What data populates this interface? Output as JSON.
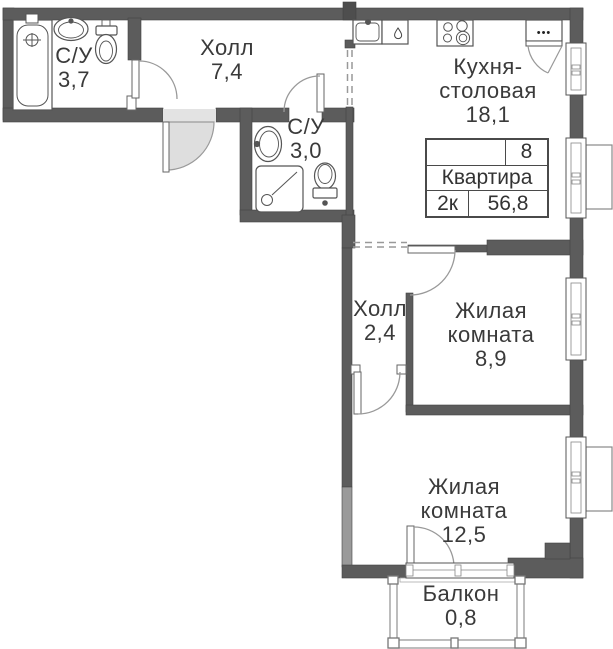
{
  "apartment_card": {
    "number": "8",
    "title": "Квартира",
    "rooms_count": "2к",
    "total_area": "56,8"
  },
  "rooms": {
    "bathroom_top": {
      "name": "С/У",
      "area": "3,7"
    },
    "hall_top": {
      "name": "Холл",
      "area": "7,4"
    },
    "kitchen": {
      "line1": "Кухня-",
      "line2": "столовая",
      "area": "18,1"
    },
    "bathroom_mid": {
      "name": "С/У",
      "area": "3,0"
    },
    "hall_mid": {
      "name": "Холл",
      "area": "2,4"
    },
    "living_room_small": {
      "line1": "Жилая",
      "line2": "комната",
      "area": "8,9"
    },
    "living_room_large": {
      "line1": "Жилая",
      "line2": "комната",
      "area": "12,5"
    },
    "balcony": {
      "name": "Балкон",
      "area": "0,8"
    }
  },
  "icons": {
    "cabinet_dots": "•••"
  },
  "colors": {
    "wall": "#5c5c5c",
    "wall_light": "#9a9a9a",
    "door_swing_fill": "#dedede",
    "text": "#3a3a3a"
  }
}
